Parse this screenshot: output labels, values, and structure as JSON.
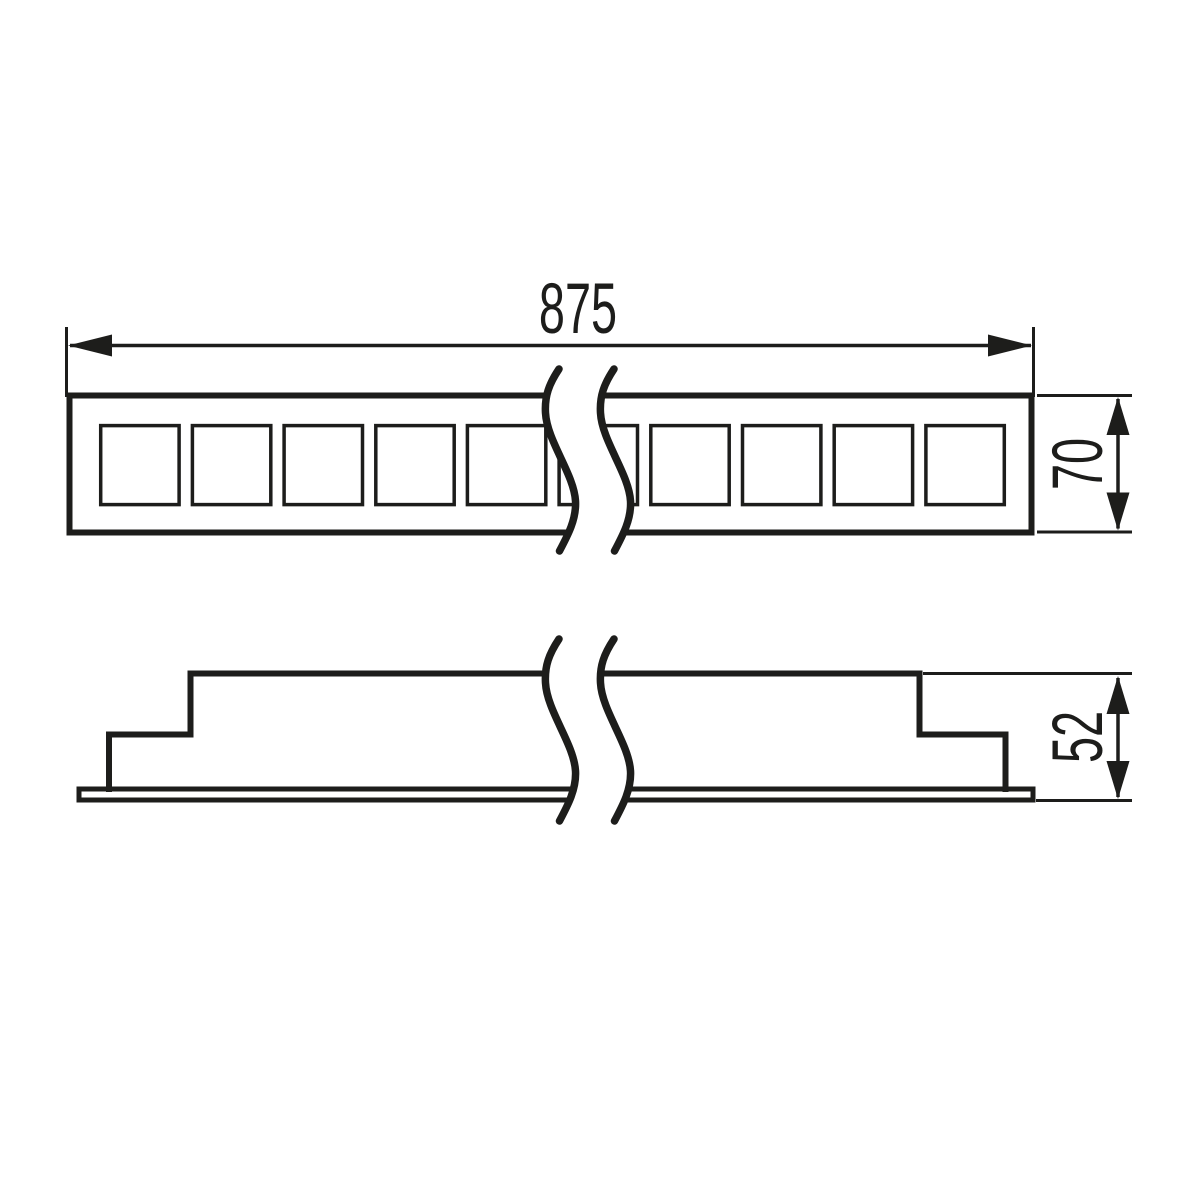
{
  "drawing": {
    "type": "technical-dimension-drawing",
    "background_color": "#ffffff",
    "line_color": "#1d1d1b",
    "dimensions": {
      "top_width": "875",
      "top_height": "70",
      "side_height": "52"
    },
    "views": {
      "top_view": {
        "description": "front view of linear luminaire with row of square cutouts, interrupted by break symbol",
        "visible_full_cutouts": 9,
        "break_symbol": "double S-curve"
      },
      "side_view": {
        "description": "stepped side profile with thin bottom flange, interrupted by break symbol",
        "break_symbol": "double S-curve"
      }
    }
  }
}
